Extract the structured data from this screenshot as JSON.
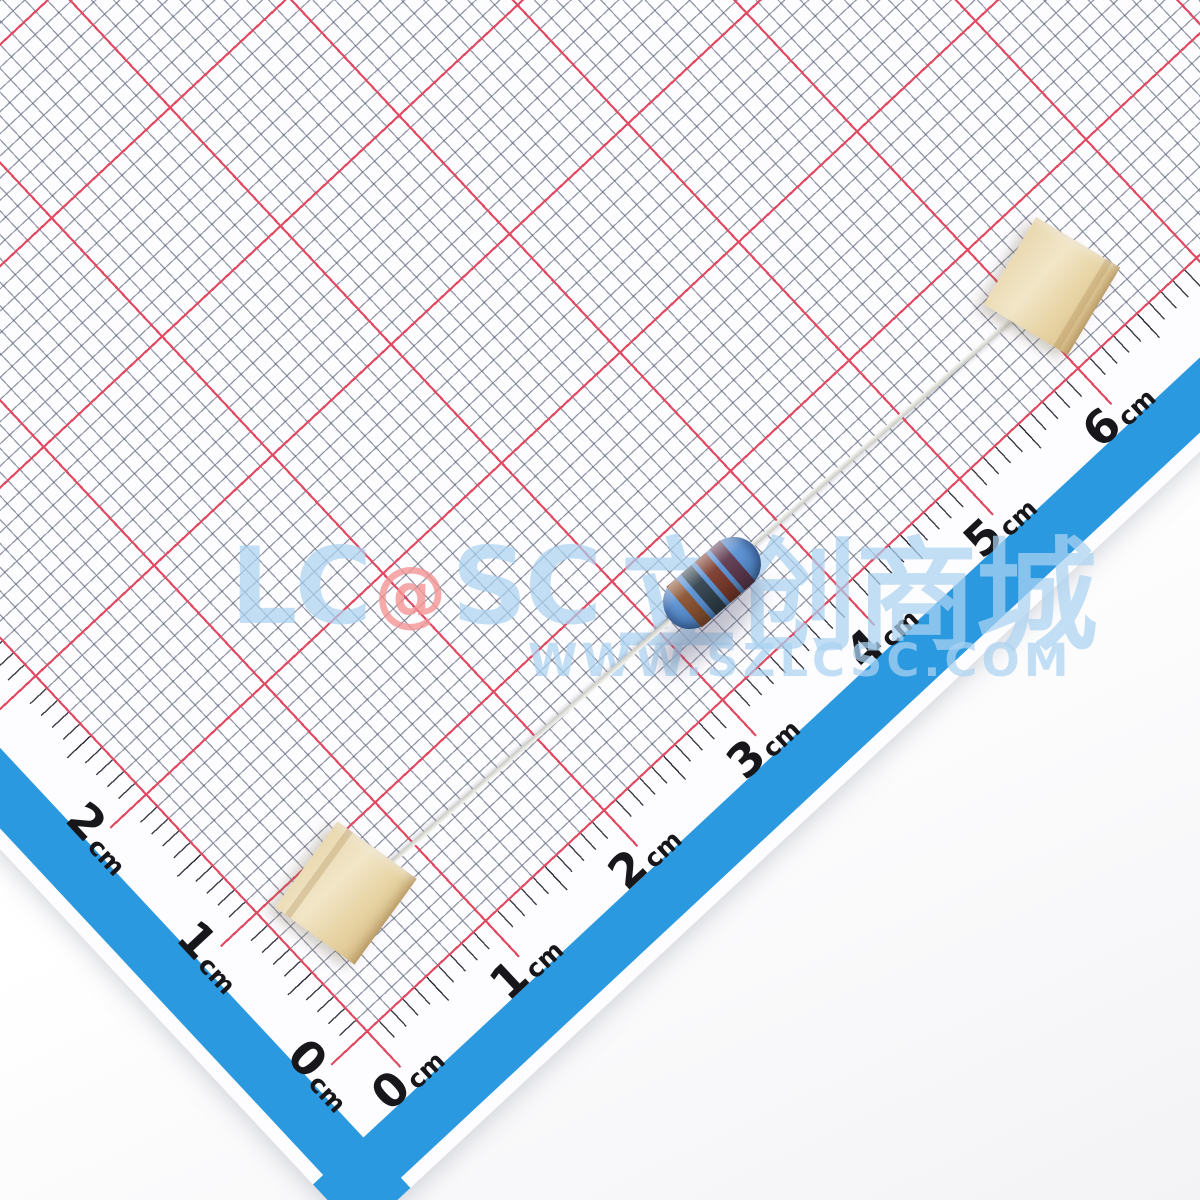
{
  "scene": {
    "type": "product-photo",
    "subject": "axial metal film resistor taped to millimeter grid paper",
    "unit": "cm"
  },
  "colors": {
    "paper-bg": "#fdfcff",
    "grid-fine": "rgba(86,94,118,0.62)",
    "grid-red": "#e24a62",
    "tick-black": "rgba(35,38,50,0.88)",
    "border-blue": "#2b99e0",
    "label-text": "#17171b",
    "watermark-blue": "rgba(171,211,241,0.72)",
    "watermark-red": "rgba(242,148,148,0.8)",
    "resistor-body": "#5b93d6"
  },
  "ruler": {
    "unit": "cm",
    "bottom_labels": [
      "0",
      "1",
      "2",
      "3",
      "4",
      "5",
      "6"
    ],
    "left_labels": [
      "0",
      "1",
      "2"
    ]
  },
  "watermark": {
    "logo_left": "LC",
    "logo_at": "@",
    "logo_right": "SC",
    "brand_cn": "立创商城",
    "website": "WWW.SZLCSC.COM"
  },
  "resistor": {
    "kind": "metal-film-resistor",
    "band_colors": [
      "#8a5230",
      "#33434e",
      "#7c3b2c",
      "#5f3a50"
    ]
  },
  "tape": {
    "pieces": [
      "top-right",
      "bottom-left"
    ]
  }
}
